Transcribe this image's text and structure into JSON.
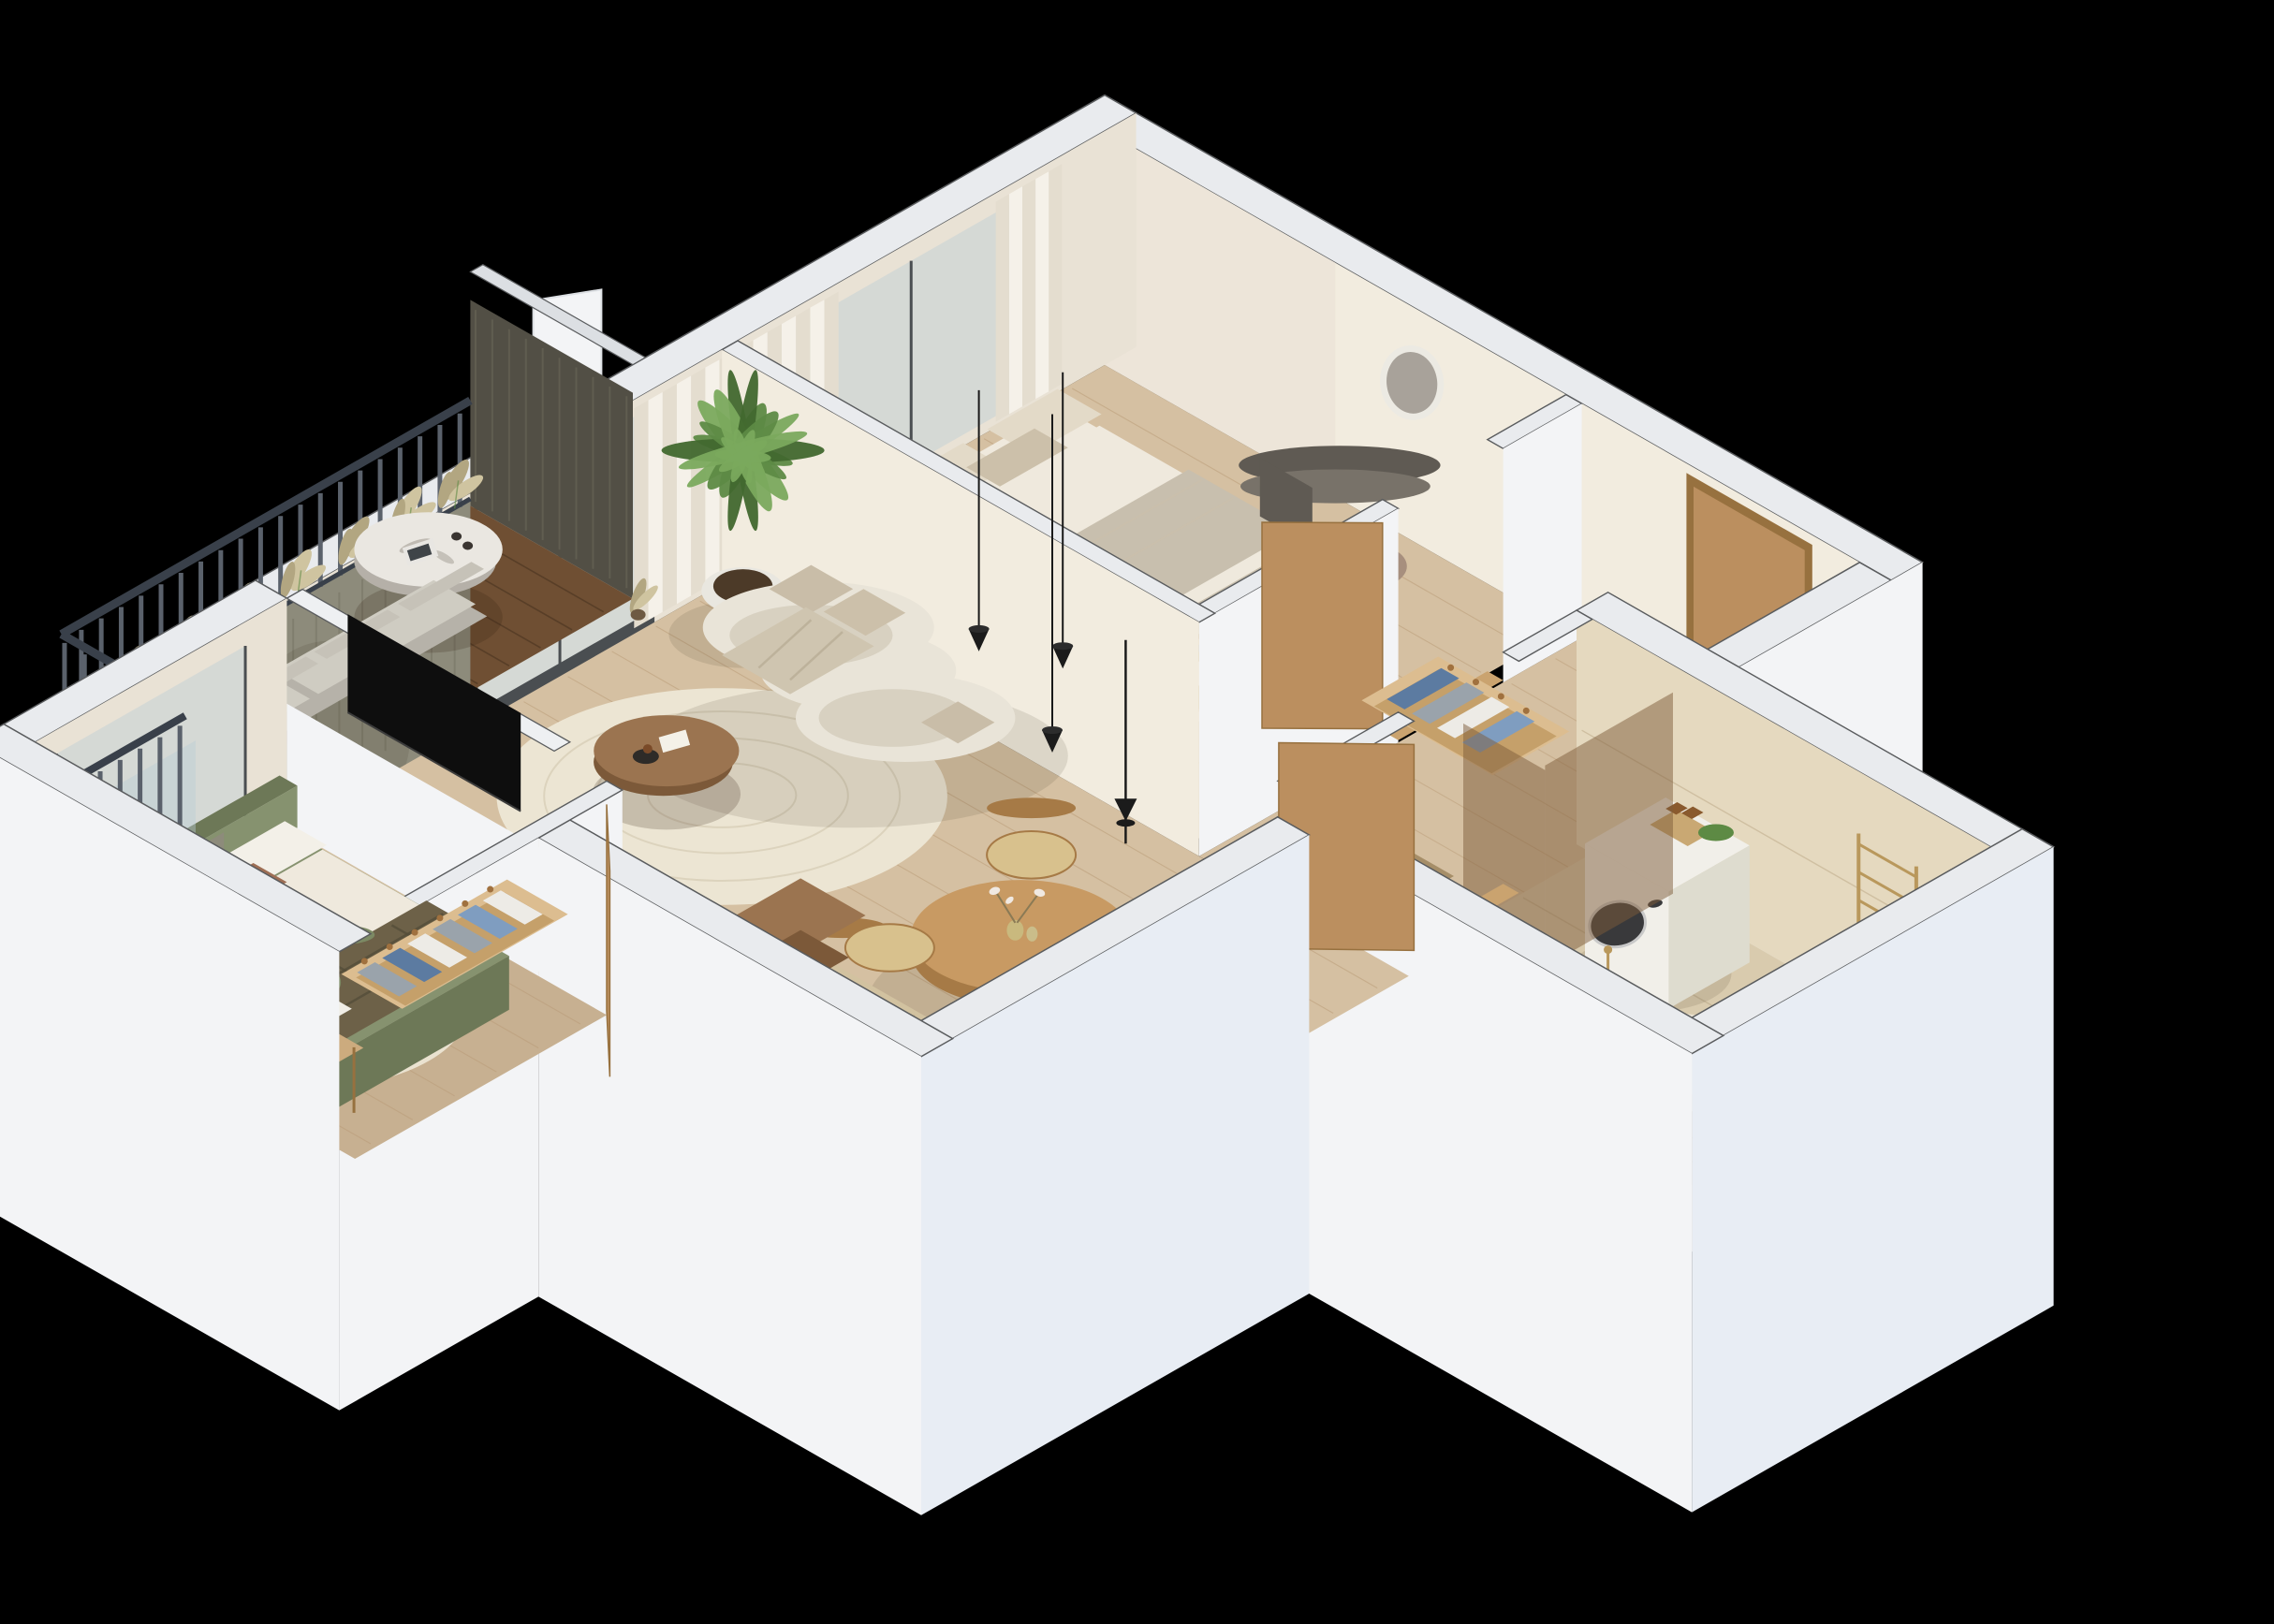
{
  "scene": {
    "title": "Isometric 3D cutaway floor plan render of a furnished apartment on a black background",
    "view": "isometric top-down cutaway",
    "background": "#000000"
  },
  "rooms": [
    {
      "id": "master-bedroom",
      "label": "Master bedroom",
      "furniture": [
        "double-bed",
        "beige-linens",
        "vanity-dresser",
        "led-round-mirror",
        "pouf",
        "open-wardrobe-with-clothes",
        "white-curtains",
        "window"
      ]
    },
    {
      "id": "living-room",
      "label": "Living room",
      "furniture": [
        "curved-cream-sofa",
        "throw-blanket",
        "coffee-table",
        "oval-cream-rug",
        "palm-plant",
        "pampas-vase",
        "tv-half-wall",
        "tv",
        "floor-lamp",
        "pendant-lamps",
        "sliding-balcony-door",
        "curtains",
        "open-window-sash"
      ]
    },
    {
      "id": "dining-area",
      "label": "Dining area",
      "furniture": [
        "round-wood-table",
        "four-wood-chairs",
        "vases-with-blossoms",
        "black-pendant-cones"
      ]
    },
    {
      "id": "kitchen",
      "label": "Kitchen",
      "furniture": [
        "beige-tile-floor",
        "counter",
        "black-induction-cooktop",
        "sink-with-brass-tap",
        "cutting-boards",
        "open-wood-crate"
      ]
    },
    {
      "id": "hallway",
      "label": "Hallway / entry",
      "furniture": [
        "wood-entry-door",
        "open-wardrobe-with-clothes",
        "brown-runner-rug"
      ]
    },
    {
      "id": "bathroom",
      "label": "Bathroom",
      "furniture": [
        "washing-machine",
        "amber-bottles",
        "bronze-shower-glass",
        "brass-towel-ladder",
        "wash-basin-unit",
        "wood-stool-with-towels",
        "freestanding-bathtub",
        "beige-stone-tiles"
      ]
    },
    {
      "id": "second-bedroom",
      "label": "Second bedroom",
      "furniture": [
        "green-upholstered-bed",
        "plaid-throw",
        "white-duvet",
        "desk",
        "green-desk-chair",
        "sphere-lamp",
        "shelf-unit",
        "open-wardrobe-with-clothes",
        "cream-rug",
        "juliet-glass-balustrade"
      ]
    },
    {
      "id": "balcony",
      "label": "Balcony",
      "furniture": [
        "dark-wood-deck",
        "dark-metal-railing",
        "pampas-grass",
        "marble-bistro-table",
        "magazine-and-cups",
        "grey-outdoor-sofa",
        "brick-clad-parapet"
      ]
    }
  ],
  "colors": {
    "bg": "#000000",
    "wallTop": "#e9ebee",
    "wallTopShade": "#dcdfe3",
    "wallEdge": "#5a5c5e",
    "wallFaceLight": "#f3f4f6",
    "wallFaceShade": "#e2e5ea",
    "wallFaceBlue": "#e8edf4",
    "intBeige": "#e9e2d5",
    "intBeigeLit": "#f2ecdf",
    "intShade": "#d8d0c0",
    "intDark": "#cec5b2",
    "woodFloor": "#d5c0a2",
    "woodFloorDark": "#c7b091",
    "woodLine": "#b3946f",
    "tileKitchen": "#d2c2a0",
    "tileKitchenTop": "#ddd0ae",
    "tileBath": "#d9cbae",
    "tileBathLight": "#e5d9bf",
    "tileLine": "#bfae8e",
    "deck": "#6f4f33",
    "deckDark": "#5b3e26",
    "deckLine": "#4a3420",
    "railDark": "#39404a",
    "railSlat": "#5a616b",
    "railLight": "#9099a3",
    "brick": "#8d8b7b",
    "brickDark": "#6e6c5c",
    "brickShadow": "#524f45",
    "glass": "rgba(185,205,215,0.42)",
    "glassBronze": "rgba(125,92,58,0.5)",
    "frameDark": "#4a4e51",
    "curtain": "#f5f1e9",
    "curtainShade": "#e4ddcf",
    "sofa": "#e9e4d8",
    "sofaShade": "#d8d1c1",
    "cushion": "#c9bda8",
    "throw": "#cfc5b0",
    "rug": "#ece5d3",
    "rugLine": "#dcd3bd",
    "coffeeWood": "#9b7450",
    "coffeeWoodDark": "#7c5939",
    "diningWood": "#c89a63",
    "diningWoodDark": "#a67a46",
    "chairSeat": "#d8c18d",
    "bedWhite": "#efe9dd",
    "bedBlanket": "#c8bfae",
    "pillow": "#e3dac8",
    "pillowDark": "#ccc0aa",
    "pillowBrown": "#9e6e54",
    "vanity": "#5f5a53",
    "vanityLight": "#787269",
    "mirrorGlass": "#a8a29a",
    "mirrorRing": "#eceae3",
    "pouf": "#a78f7e",
    "door": "#bb8f5f",
    "doorDark": "#97713f",
    "thresh": "#caa36f",
    "wardrobe": "#dcbd90",
    "wardrobeInner": "#c5a06a",
    "hanger": "#a0713f",
    "clWhite": "#edebe6",
    "clBlue": "#7f9dc0",
    "clGrey": "#9aa3ab",
    "clDenim": "#5c7ba1",
    "tv": "#0e0e0e",
    "lamp": "#1b1b1b",
    "green": "#5d8a44",
    "greenDark": "#41682e",
    "greenLight": "#7aa95d",
    "pot": "#e9e7e0",
    "soil": "#4c3a28",
    "pampas": "#cfc4a0",
    "pampasDark": "#b2a681",
    "marble": "#eae7e1",
    "marbleVein": "#b5b0a8",
    "washer": "#f1efe9",
    "washerDark": "#39393b",
    "washerRing": "#c9c9c9",
    "amber": "#8a5a2e",
    "brass": "#b9985c",
    "tub": "#ece4d4",
    "tubInner": "#f7f3ea",
    "stool": "#c9a873",
    "towel": "#f3f0e8",
    "greenBed": "#86926f",
    "greenBedDark": "#6d7857",
    "plaid": "#6d6148",
    "plaidLine": "#544e3a",
    "desk": "#ccab7e",
    "chairGreen": "#7c8a64",
    "rug2": "#eae2d0",
    "shadow": "rgba(50,32,15,0.20)",
    "shadowSoft": "rgba(50,32,15,0.11)"
  }
}
